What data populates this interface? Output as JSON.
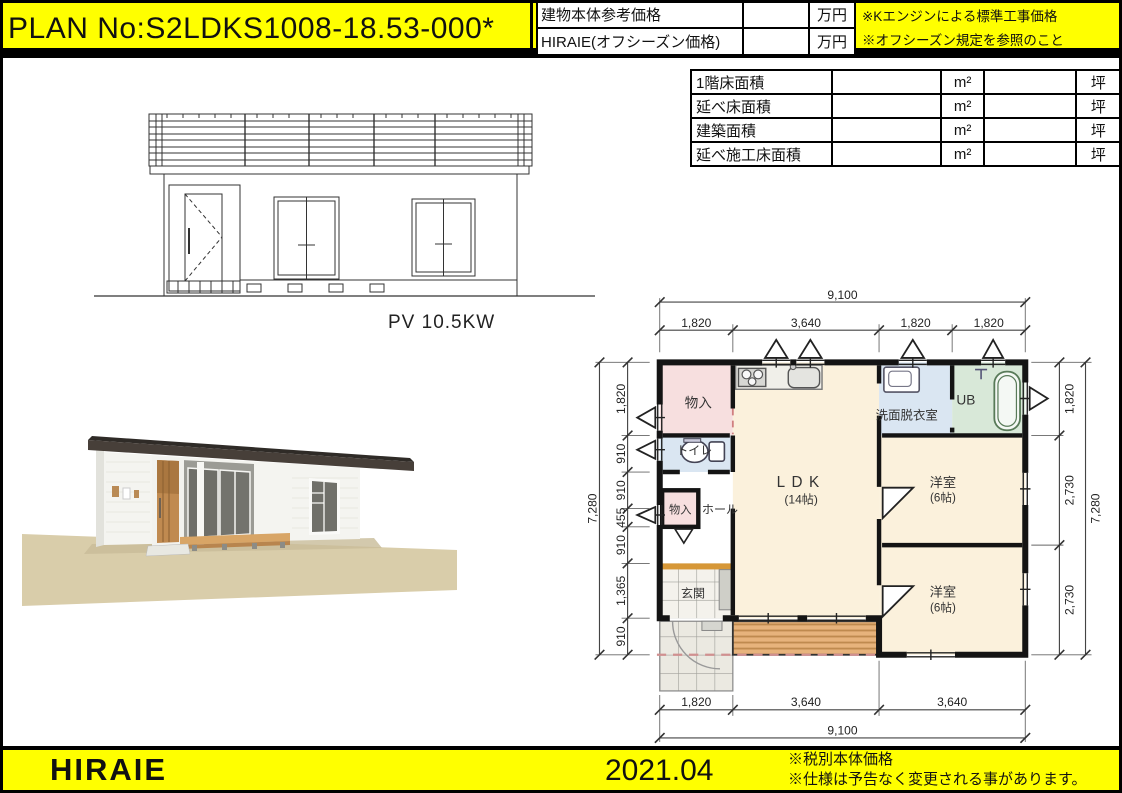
{
  "header": {
    "plan_no": "PLAN No:S2LDKS1008-18.53-000*",
    "price_rows": [
      {
        "label": "建物本体参考価格",
        "value": "",
        "unit": "万円"
      },
      {
        "label": "HIRAIE(オフシーズン価格)",
        "value": "",
        "unit": "万円"
      }
    ],
    "notes": [
      "※Kエンジンによる標準工事価格",
      "※オフシーズン規定を参照のこと"
    ]
  },
  "area_table": {
    "rows": [
      {
        "label": "1階床面積",
        "value_m2": "",
        "unit_m2": "m²",
        "value_tsubo": "",
        "unit_tsubo": "坪"
      },
      {
        "label": "延べ床面積",
        "value_m2": "",
        "unit_m2": "m²",
        "value_tsubo": "",
        "unit_tsubo": "坪"
      },
      {
        "label": "建築面積",
        "value_m2": "",
        "unit_m2": "m²",
        "value_tsubo": "",
        "unit_tsubo": "坪"
      },
      {
        "label": "延べ施工床面積",
        "value_m2": "",
        "unit_m2": "m²",
        "value_tsubo": "",
        "unit_tsubo": "坪"
      }
    ]
  },
  "elevation": {
    "pv_label": "PV 10.5KW"
  },
  "floor_plan": {
    "rooms": {
      "closet_top": "物入",
      "toilet": "トイレ",
      "closet_hall": "物入",
      "hall": "ホール",
      "entrance": "玄関",
      "ldk": "LDK",
      "ldk_size": "(14帖)",
      "washroom": "洗面脱衣室",
      "bath": "UB",
      "bedroom1": "洋室",
      "bedroom1_size": "(6帖)",
      "bedroom2": "洋室",
      "bedroom2_size": "(6帖)"
    },
    "dims": {
      "top_total": "9,100",
      "top_segs": [
        "1,820",
        "3,640",
        "1,820",
        "1,820"
      ],
      "bottom_segs": [
        "1,820",
        "3,640",
        "3,640"
      ],
      "bottom_total": "9,100",
      "left_total": "7,280",
      "left_segs": [
        "1,820",
        "910",
        "910",
        "455",
        "910",
        "1,365",
        "910"
      ],
      "right_segs": [
        "1,820",
        "2,730",
        "2,730"
      ],
      "right_total": "7,280"
    }
  },
  "footer": {
    "brand": "HIRAIE",
    "date": "2021.04",
    "notes": [
      "※税別本体価格",
      "※仕様は予告なく変更される事があります。"
    ]
  },
  "colors": {
    "banner": "#ffff00",
    "wall_line": "#141414",
    "room_cream": "#fbf1dc",
    "room_pink": "#f7dfdf",
    "room_blue": "#dae6f2",
    "room_green": "#d8e8d8",
    "deck": "#e7b37c",
    "step_orange": "#d69737",
    "roof_3d": "#473f39",
    "door_3d": "#c08a50",
    "ground_3d": "#d9cdaa"
  }
}
